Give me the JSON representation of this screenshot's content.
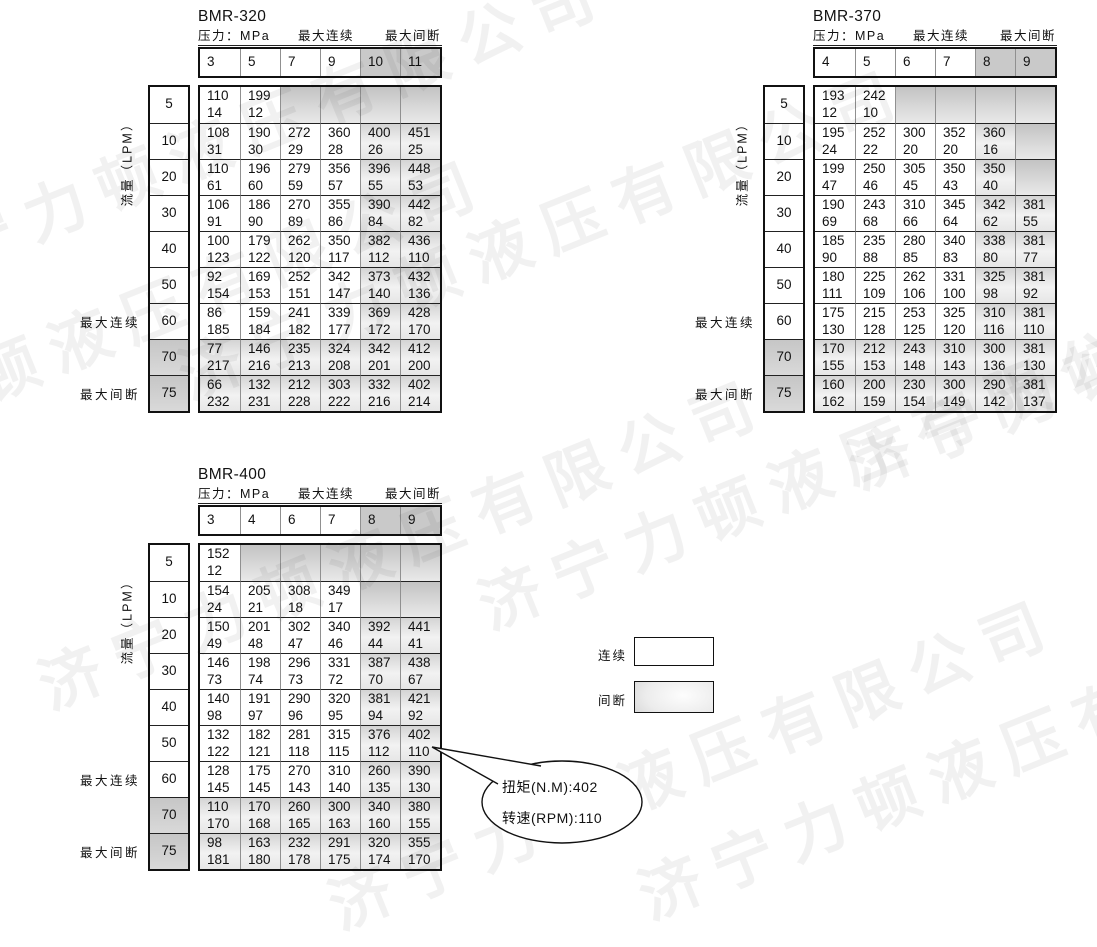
{
  "watermark": {
    "text": "济宁力顿液压有限公司"
  },
  "labels": {
    "pressure_unit": "压力：MPa",
    "max_continuous": "最大连续",
    "max_intermittent": "最大间断",
    "flow_unit": "流量（LPM）"
  },
  "legend": {
    "continuous_label": "连续",
    "intermittent_label": "间断"
  },
  "callout": {
    "torque_line": "扭矩(N.M):402",
    "speed_line": "转速(RPM):110"
  },
  "colors": {
    "shaded_header": "#c9c9c9",
    "shaded_cell_top": "#d4d4d4",
    "empty_cell_top": "#c3c3c3",
    "border": "#111111",
    "grid_inner_line": "#909090"
  },
  "tables": [
    {
      "id": "bmr-320",
      "title": "BMR-320",
      "pressures": [
        "3",
        "5",
        "7",
        "9",
        "10",
        "11"
      ],
      "flows": [
        "5",
        "10",
        "20",
        "30",
        "40",
        "50",
        "60",
        "70",
        "75"
      ],
      "intermittent_col_start": 4,
      "intermittent_row_start": 7,
      "cells": [
        [
          [
            "110",
            "14"
          ],
          [
            "199",
            "12"
          ],
          null,
          null,
          null,
          null
        ],
        [
          [
            "108",
            "31"
          ],
          [
            "190",
            "30"
          ],
          [
            "272",
            "29"
          ],
          [
            "360",
            "28"
          ],
          [
            "400",
            "26"
          ],
          [
            "451",
            "25"
          ]
        ],
        [
          [
            "110",
            "61"
          ],
          [
            "196",
            "60"
          ],
          [
            "279",
            "59"
          ],
          [
            "356",
            "57"
          ],
          [
            "396",
            "55"
          ],
          [
            "448",
            "53"
          ]
        ],
        [
          [
            "106",
            "91"
          ],
          [
            "186",
            "90"
          ],
          [
            "270",
            "89"
          ],
          [
            "355",
            "86"
          ],
          [
            "390",
            "84"
          ],
          [
            "442",
            "82"
          ]
        ],
        [
          [
            "100",
            "123"
          ],
          [
            "179",
            "122"
          ],
          [
            "262",
            "120"
          ],
          [
            "350",
            "117"
          ],
          [
            "382",
            "112"
          ],
          [
            "436",
            "110"
          ]
        ],
        [
          [
            "92",
            "154"
          ],
          [
            "169",
            "153"
          ],
          [
            "252",
            "151"
          ],
          [
            "342",
            "147"
          ],
          [
            "373",
            "140"
          ],
          [
            "432",
            "136"
          ]
        ],
        [
          [
            "86",
            "185"
          ],
          [
            "159",
            "184"
          ],
          [
            "241",
            "182"
          ],
          [
            "339",
            "177"
          ],
          [
            "369",
            "172"
          ],
          [
            "428",
            "170"
          ]
        ],
        [
          [
            "77",
            "217"
          ],
          [
            "146",
            "216"
          ],
          [
            "235",
            "213"
          ],
          [
            "324",
            "208"
          ],
          [
            "342",
            "201"
          ],
          [
            "412",
            "200"
          ]
        ],
        [
          [
            "66",
            "232"
          ],
          [
            "132",
            "231"
          ],
          [
            "212",
            "228"
          ],
          [
            "303",
            "222"
          ],
          [
            "332",
            "216"
          ],
          [
            "402",
            "214"
          ]
        ]
      ]
    },
    {
      "id": "bmr-370",
      "title": "BMR-370",
      "pressures": [
        "4",
        "5",
        "6",
        "7",
        "8",
        "9"
      ],
      "flows": [
        "5",
        "10",
        "20",
        "30",
        "40",
        "50",
        "60",
        "70",
        "75"
      ],
      "intermittent_col_start": 4,
      "intermittent_row_start": 7,
      "cells": [
        [
          [
            "193",
            "12"
          ],
          [
            "242",
            "10"
          ],
          null,
          null,
          null,
          null
        ],
        [
          [
            "195",
            "24"
          ],
          [
            "252",
            "22"
          ],
          [
            "300",
            "20"
          ],
          [
            "352",
            "20"
          ],
          [
            "360",
            "16"
          ],
          null
        ],
        [
          [
            "199",
            "47"
          ],
          [
            "250",
            "46"
          ],
          [
            "305",
            "45"
          ],
          [
            "350",
            "43"
          ],
          [
            "350",
            "40"
          ],
          null
        ],
        [
          [
            "190",
            "69"
          ],
          [
            "243",
            "68"
          ],
          [
            "310",
            "66"
          ],
          [
            "345",
            "64"
          ],
          [
            "342",
            "62"
          ],
          [
            "381",
            "55"
          ]
        ],
        [
          [
            "185",
            "90"
          ],
          [
            "235",
            "88"
          ],
          [
            "280",
            "85"
          ],
          [
            "340",
            "83"
          ],
          [
            "338",
            "80"
          ],
          [
            "381",
            "77"
          ]
        ],
        [
          [
            "180",
            "111"
          ],
          [
            "225",
            "109"
          ],
          [
            "262",
            "106"
          ],
          [
            "331",
            "100"
          ],
          [
            "325",
            "98"
          ],
          [
            "381",
            "92"
          ]
        ],
        [
          [
            "175",
            "130"
          ],
          [
            "215",
            "128"
          ],
          [
            "253",
            "125"
          ],
          [
            "325",
            "120"
          ],
          [
            "310",
            "116"
          ],
          [
            "381",
            "110"
          ]
        ],
        [
          [
            "170",
            "155"
          ],
          [
            "212",
            "153"
          ],
          [
            "243",
            "148"
          ],
          [
            "310",
            "143"
          ],
          [
            "300",
            "136"
          ],
          [
            "381",
            "130"
          ]
        ],
        [
          [
            "160",
            "162"
          ],
          [
            "200",
            "159"
          ],
          [
            "230",
            "154"
          ],
          [
            "300",
            "149"
          ],
          [
            "290",
            "142"
          ],
          [
            "381",
            "137"
          ]
        ]
      ]
    },
    {
      "id": "bmr-400",
      "title": "BMR-400",
      "pressures": [
        "3",
        "4",
        "6",
        "7",
        "8",
        "9"
      ],
      "flows": [
        "5",
        "10",
        "20",
        "30",
        "40",
        "50",
        "60",
        "70",
        "75"
      ],
      "intermittent_col_start": 4,
      "intermittent_row_start": 7,
      "cells": [
        [
          [
            "152",
            "12"
          ],
          null,
          null,
          null,
          null,
          null
        ],
        [
          [
            "154",
            "24"
          ],
          [
            "205",
            "21"
          ],
          [
            "308",
            "18"
          ],
          [
            "349",
            "17"
          ],
          null,
          null
        ],
        [
          [
            "150",
            "49"
          ],
          [
            "201",
            "48"
          ],
          [
            "302",
            "47"
          ],
          [
            "340",
            "46"
          ],
          [
            "392",
            "44"
          ],
          [
            "441",
            "41"
          ]
        ],
        [
          [
            "146",
            "73"
          ],
          [
            "198",
            "74"
          ],
          [
            "296",
            "73"
          ],
          [
            "331",
            "72"
          ],
          [
            "387",
            "70"
          ],
          [
            "438",
            "67"
          ]
        ],
        [
          [
            "140",
            "98"
          ],
          [
            "191",
            "97"
          ],
          [
            "290",
            "96"
          ],
          [
            "320",
            "95"
          ],
          [
            "381",
            "94"
          ],
          [
            "421",
            "92"
          ]
        ],
        [
          [
            "132",
            "122"
          ],
          [
            "182",
            "121"
          ],
          [
            "281",
            "118"
          ],
          [
            "315",
            "115"
          ],
          [
            "376",
            "112"
          ],
          [
            "402",
            "110"
          ]
        ],
        [
          [
            "128",
            "145"
          ],
          [
            "175",
            "145"
          ],
          [
            "270",
            "143"
          ],
          [
            "310",
            "140"
          ],
          [
            "260",
            "135"
          ],
          [
            "390",
            "130"
          ]
        ],
        [
          [
            "110",
            "170"
          ],
          [
            "170",
            "168"
          ],
          [
            "260",
            "165"
          ],
          [
            "300",
            "163"
          ],
          [
            "340",
            "160"
          ],
          [
            "380",
            "155"
          ]
        ],
        [
          [
            "98",
            "181"
          ],
          [
            "163",
            "180"
          ],
          [
            "232",
            "178"
          ],
          [
            "291",
            "175"
          ],
          [
            "320",
            "174"
          ],
          [
            "355",
            "170"
          ]
        ]
      ]
    }
  ]
}
